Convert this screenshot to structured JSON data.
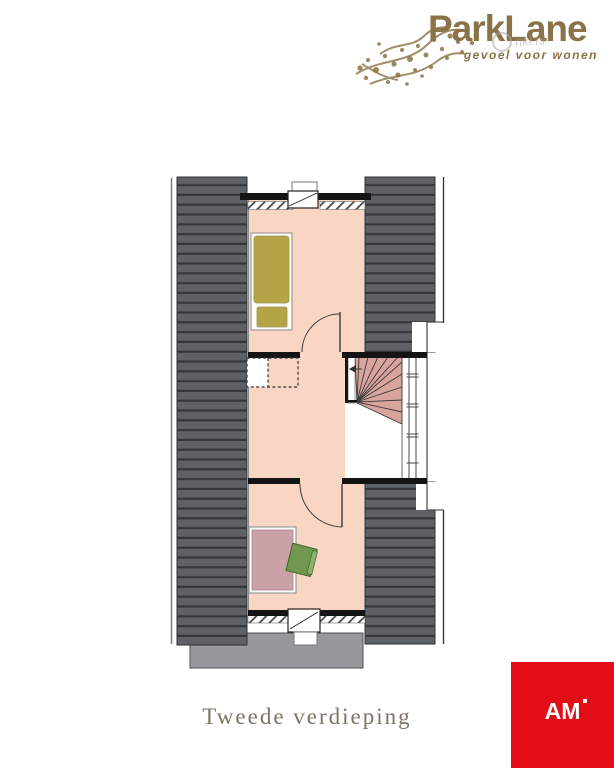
{
  "brand": {
    "name": "ParkLane",
    "tagline": "gevoel voor wonen",
    "brand_color": "#8a7347"
  },
  "watermark": {
    "text": "riki.nl"
  },
  "floorplan": {
    "caption": "Tweede verdieping",
    "colors": {
      "roof": "#5e6266",
      "roof_stripe": "#35383b",
      "floor": "#f8d6c3",
      "stairs": "#d9a49c",
      "bed": "#b4a446",
      "desk": "#c9a1a6",
      "chair": "#70984e",
      "dormer_roof": "#96989b",
      "wall": "#141414"
    }
  },
  "publisher": {
    "logo_text": "AM",
    "logo_color": "#e30d17"
  }
}
